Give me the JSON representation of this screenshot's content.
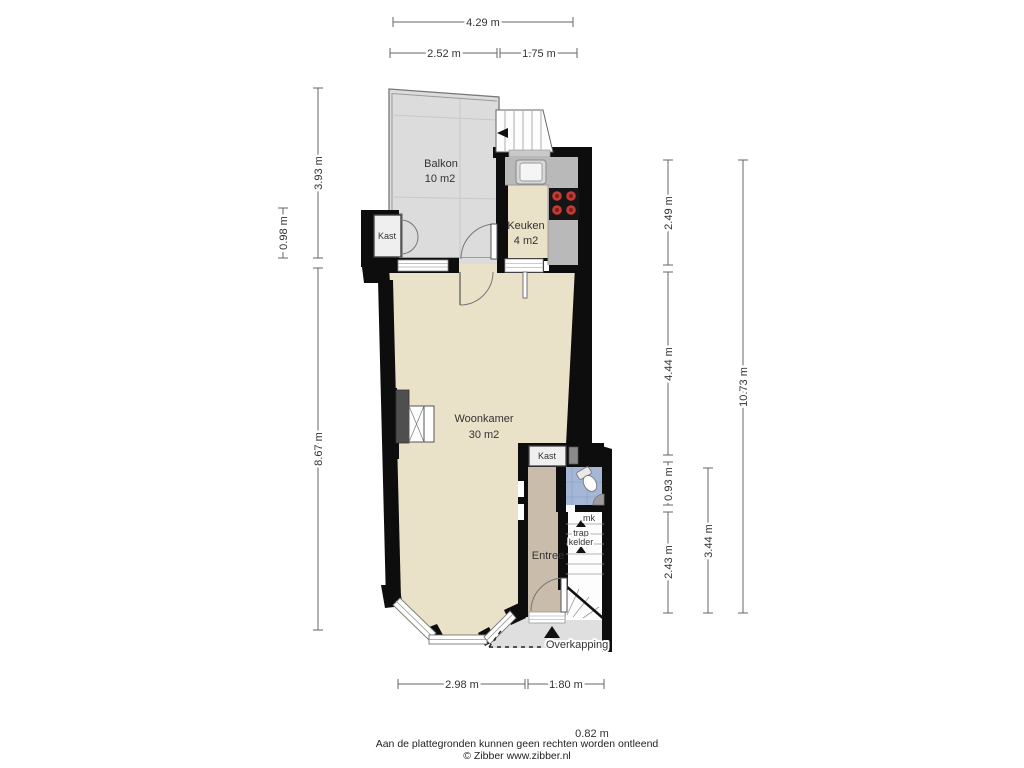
{
  "dimensions": {
    "top_total": "4.29 m",
    "top_left": "2.52 m",
    "top_right": "1.75 m",
    "side_balkon": "3.93 m",
    "side_kast": "0.98 m",
    "side_woonkamer": "8.67 m",
    "right_keuken": "2.49 m",
    "right_woonkamer": "4.44 m",
    "right_kast": "0.93 m",
    "right_entree": "2.43 m",
    "right_hal": "3.44 m",
    "right_total": "10.73 m",
    "bottom_left": "2.98 m",
    "bottom_right": "1.80 m",
    "bottom_extra": "0.82 m"
  },
  "rooms": {
    "balkon": {
      "label": "Balkon",
      "area": "10 m2"
    },
    "keuken": {
      "label": "Keuken",
      "area": "4 m2"
    },
    "kast_boven": {
      "label": "Kast"
    },
    "woonkamer": {
      "label": "Woonkamer",
      "area": "30 m2"
    },
    "kast_onder": {
      "label": "Kast"
    },
    "meterkast": {
      "label": "mk"
    },
    "trapkelder": {
      "line1": "trap",
      "line2": "kelder"
    },
    "entree": {
      "label": "Entree"
    },
    "overkapping": {
      "label": "Overkapping"
    }
  },
  "footer": {
    "disclaimer": "Aan de plattegronden kunnen geen rechten worden ontleend",
    "copyright": "© Zibber www.zibber.nl"
  },
  "colors": {
    "wall": "#0d0d0d",
    "floor": "#e9e1c8",
    "entree_floor": "#c9bcaa",
    "balcony": "#dcdcdc",
    "porch": "#dfdfdf",
    "counter": "#b9b9b9",
    "tile": "#a4b7d6",
    "burner": "#c23b35"
  }
}
